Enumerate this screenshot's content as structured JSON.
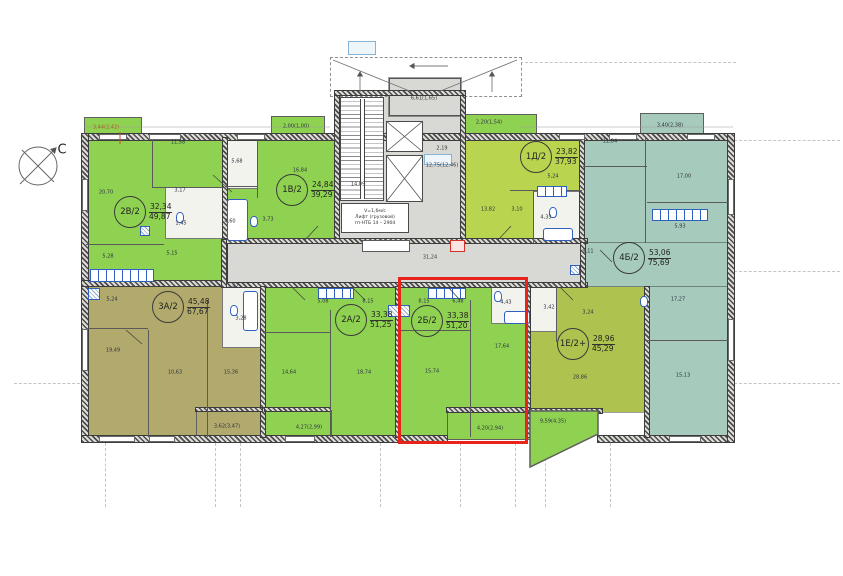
{
  "compass": {
    "letter": "С"
  },
  "apartments": [
    {
      "id": "2v-2",
      "label": "2В/2",
      "living": "32,34",
      "total": "49,87",
      "x": 130,
      "y": 212,
      "highlighted": false
    },
    {
      "id": "1v-2",
      "label": "1В/2",
      "living": "24,84",
      "total": "39,29",
      "x": 292,
      "y": 190,
      "highlighted": false
    },
    {
      "id": "1d-2",
      "label": "1Д/2",
      "living": "23,82",
      "total": "37,93",
      "x": 536,
      "y": 157,
      "highlighted": false
    },
    {
      "id": "4b-2",
      "label": "4Б/2",
      "living": "53,06",
      "total": "75,69",
      "x": 629,
      "y": 258,
      "highlighted": false
    },
    {
      "id": "3a-2",
      "label": "3А/2",
      "living": "45,48",
      "total": "67,67",
      "x": 168,
      "y": 307,
      "highlighted": false
    },
    {
      "id": "2a-2",
      "label": "2А/2",
      "living": "33,38",
      "total": "51,25",
      "x": 351,
      "y": 320,
      "highlighted": false
    },
    {
      "id": "2b-2",
      "label": "2Б/2",
      "living": "33,38",
      "total": "51,20",
      "x": 427,
      "y": 321,
      "highlighted": true
    },
    {
      "id": "1e-2",
      "label": "1Е/2+",
      "living": "28,96",
      "total": "45,29",
      "x": 573,
      "y": 344,
      "highlighted": false
    }
  ],
  "room_labels": [
    {
      "t": "20,70",
      "x": 106,
      "y": 193
    },
    {
      "t": "11,58",
      "x": 178,
      "y": 143
    },
    {
      "t": "3,17",
      "x": 180,
      "y": 191
    },
    {
      "t": "1,45",
      "x": 181,
      "y": 224
    },
    {
      "t": "5,15",
      "x": 172,
      "y": 254
    },
    {
      "t": "5,28",
      "x": 108,
      "y": 257
    },
    {
      "t": "16,84",
      "x": 300,
      "y": 171
    },
    {
      "t": "5,68",
      "x": 237,
      "y": 162
    },
    {
      "t": "3,73",
      "x": 268,
      "y": 220
    },
    {
      "t": "4,60",
      "x": 230,
      "y": 222
    },
    {
      "t": "13,82",
      "x": 488,
      "y": 210
    },
    {
      "t": "3,10",
      "x": 517,
      "y": 210
    },
    {
      "t": "5,24",
      "x": 553,
      "y": 177
    },
    {
      "t": "4,33",
      "x": 546,
      "y": 218
    },
    {
      "t": "11,84",
      "x": 610,
      "y": 142
    },
    {
      "t": "17,00",
      "x": 684,
      "y": 177
    },
    {
      "t": "5,93",
      "x": 680,
      "y": 227
    },
    {
      "t": "9,11",
      "x": 588,
      "y": 252
    },
    {
      "t": "17,27",
      "x": 678,
      "y": 300
    },
    {
      "t": "15,13",
      "x": 683,
      "y": 376
    },
    {
      "t": "19,49",
      "x": 113,
      "y": 351
    },
    {
      "t": "10,63",
      "x": 175,
      "y": 373
    },
    {
      "t": "15,36",
      "x": 231,
      "y": 373
    },
    {
      "t": "5,24",
      "x": 112,
      "y": 300
    },
    {
      "t": "1,42",
      "x": 233,
      "y": 287
    },
    {
      "t": "3,28",
      "x": 241,
      "y": 319
    },
    {
      "t": "14,64",
      "x": 289,
      "y": 373
    },
    {
      "t": "18,74",
      "x": 364,
      "y": 373
    },
    {
      "t": "5,08",
      "x": 323,
      "y": 302
    },
    {
      "t": "8,15",
      "x": 368,
      "y": 302
    },
    {
      "t": "8,15",
      "x": 424,
      "y": 302
    },
    {
      "t": "6,48",
      "x": 458,
      "y": 302
    },
    {
      "t": "4,43",
      "x": 506,
      "y": 303
    },
    {
      "t": "15,74",
      "x": 432,
      "y": 372
    },
    {
      "t": "17,64",
      "x": 502,
      "y": 347
    },
    {
      "t": "3,42",
      "x": 549,
      "y": 308
    },
    {
      "t": "3,24",
      "x": 588,
      "y": 313
    },
    {
      "t": "28,86",
      "x": 580,
      "y": 378
    }
  ],
  "balcony_labels": [
    {
      "t": "3,44(2,42)",
      "x": 106,
      "y": 128,
      "c": "#b05a1f"
    },
    {
      "t": "2,00(1,00)",
      "x": 296,
      "y": 127
    },
    {
      "t": "2,20(1,54)",
      "x": 489,
      "y": 123
    },
    {
      "t": "3,40(2,38)",
      "x": 670,
      "y": 126
    },
    {
      "t": "3,62(3,47)",
      "x": 227,
      "y": 427
    },
    {
      "t": "4,27(2,99)",
      "x": 309,
      "y": 428
    },
    {
      "t": "4,20(2,94)",
      "x": 490,
      "y": 429
    },
    {
      "t": "9,59(4,35)",
      "x": 553,
      "y": 422
    }
  ],
  "core_labels": [
    {
      "t": "14,09",
      "x": 358,
      "y": 185
    },
    {
      "t": "6,61(1,65)",
      "x": 424,
      "y": 99
    },
    {
      "t": "2,19",
      "x": 442,
      "y": 149
    },
    {
      "t": "12,75(12,46)",
      "x": 442,
      "y": 166
    },
    {
      "t": "31,24",
      "x": 430,
      "y": 258
    }
  ],
  "elevator_note": {
    "line1": "V=1,6м/с",
    "line2": "Лифт (грузовой)",
    "line3": "гп-НТБ 14 – 2904"
  },
  "colors": {
    "bright-green": "#8fd251",
    "lime-green": "#b9d44f",
    "olive": "#b2a96c",
    "yellow-olive": "#aec24f",
    "teal": "#a6cabb",
    "core-grey": "#d8d8d5",
    "wall-dark": "#474747",
    "fixture-blue": "#2f5fbf",
    "highlight-red": "#e8231b"
  }
}
